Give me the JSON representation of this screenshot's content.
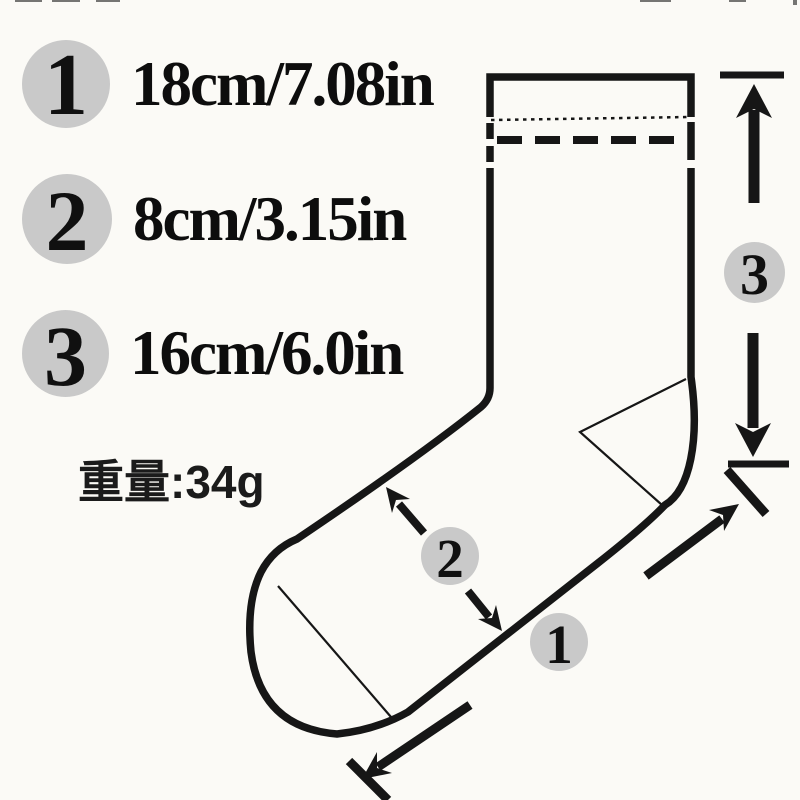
{
  "page": {
    "background": "#fbfaf6"
  },
  "measurements": {
    "items": [
      {
        "num": "1",
        "label": "18cm/7.08in"
      },
      {
        "num": "2",
        "label": "8cm/3.15in"
      },
      {
        "num": "3",
        "label": "16cm/6.0in"
      }
    ],
    "weight": "重量:34g"
  },
  "diagram": {
    "type": "sock-size-diagram",
    "badges": [
      {
        "num": "1"
      },
      {
        "num": "2"
      },
      {
        "num": "3"
      }
    ],
    "colors": {
      "line": "#161616",
      "badge_bg": "#c9c9c9",
      "text": "#0f0f0f"
    }
  }
}
